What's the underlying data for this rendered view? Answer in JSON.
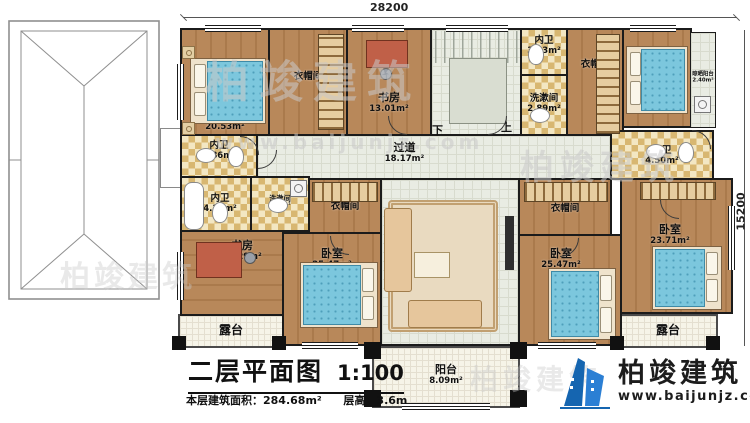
{
  "dims": {
    "top": "28200",
    "right": "15200"
  },
  "stairs": {
    "down": "下",
    "up": "上"
  },
  "rooms": {
    "bedroom_tl": {
      "label": "卧室",
      "area": "20.53m²"
    },
    "cloak_tl": {
      "label": "衣帽间"
    },
    "study_top": {
      "label": "书房",
      "area": "13.01m²"
    },
    "stairwell": {
      "label": "楼梯间",
      "area": "17.04m²"
    },
    "bath_top": {
      "label": "内卫",
      "area": "3.23m²"
    },
    "wash_top": {
      "label": "洗漱间",
      "area": "2.89m²"
    },
    "cloak_tr": {
      "label": "衣帽间"
    },
    "bedroom_tr": {
      "label": "卧室",
      "area": "18.27m²"
    },
    "dry_balcony": {
      "label": "晾晒阳台",
      "area": "2.40m²"
    },
    "bath_ml_upper": {
      "label": "内卫",
      "area": "5.86m²"
    },
    "bath_ml_lower": {
      "label": "内卫",
      "area": "4.31m²"
    },
    "wash_ml": {
      "label": "洗漱间",
      "area": "1.68m²"
    },
    "corridor": {
      "label": "过道",
      "area": "18.17m²"
    },
    "cloak_ml": {
      "label": "衣帽间"
    },
    "cloak_mr": {
      "label": "衣帽间"
    },
    "bath_mr": {
      "label": "内卫",
      "area": "4.50m²"
    },
    "study_bl": {
      "label": "书房",
      "area": "15.29m²"
    },
    "bedroom_bl": {
      "label": "卧室",
      "area": "25.47m²"
    },
    "living": {
      "label": "起居室",
      "area": "40.03m²"
    },
    "bedroom_bm": {
      "label": "卧室",
      "area": "25.47m²"
    },
    "bedroom_br": {
      "label": "卧室",
      "area": "23.71m²"
    },
    "terrace_left": {
      "label": "露台"
    },
    "terrace_right": {
      "label": "露台"
    },
    "balcony": {
      "label": "阳台",
      "area": "8.09m²"
    }
  },
  "titleblock": {
    "title": "二层平面图",
    "scale": "1:100",
    "area_label": "本层建筑面积：",
    "area_value": "284.68m²",
    "height_label": "层高：",
    "height_value": "3.6m"
  },
  "logo": {
    "name": "柏竣建筑",
    "url": "www.baijunjz.com"
  },
  "watermark": {
    "brand": "柏竣建筑",
    "url": "www.baijunjz.com"
  },
  "colors": {
    "wall": "#1b1b1b",
    "wood_floor": "#b8885a",
    "bed": "#7cc7dd",
    "logo_blue": "#1565b0"
  }
}
